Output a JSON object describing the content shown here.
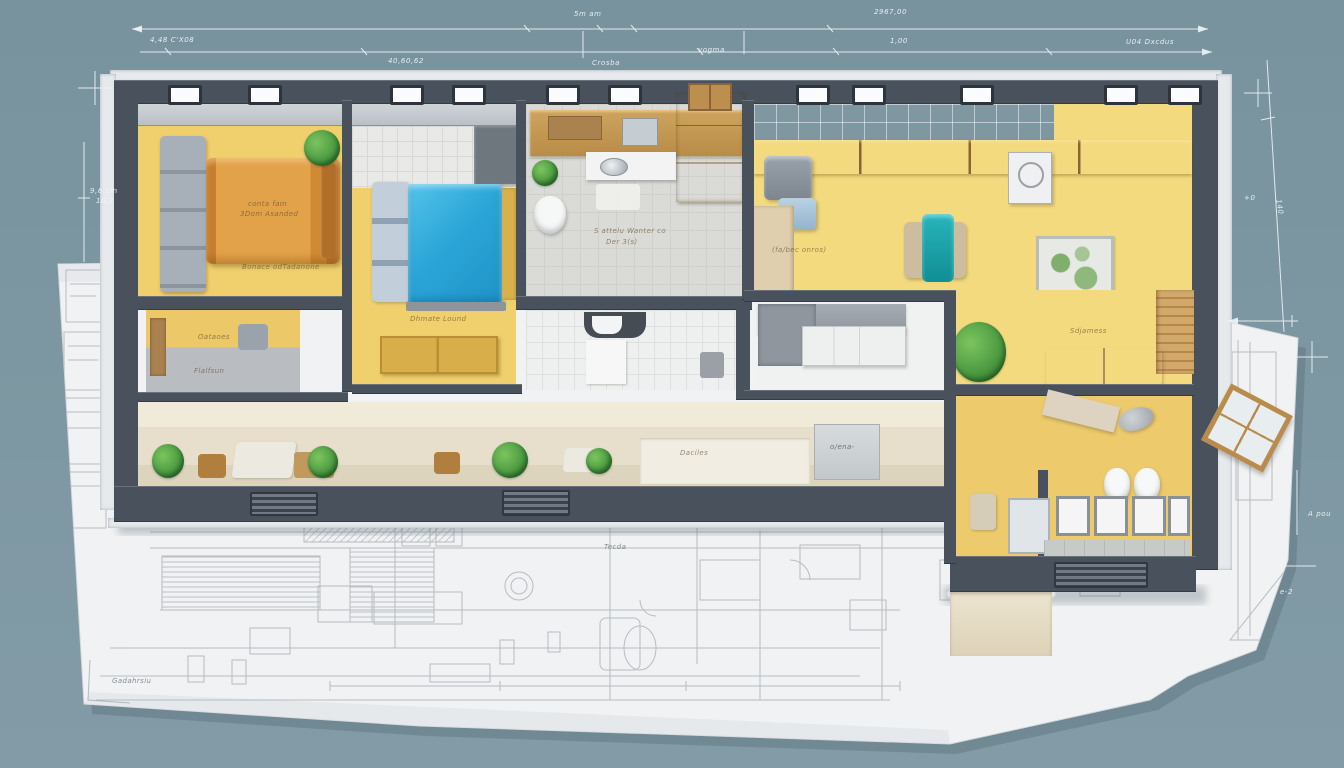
{
  "scene": {
    "description": "3D cutaway apartment floor-plan model standing on a 2D architectural blueprint sheet",
    "background_color": "#7d97a2",
    "paper_color": "#f1f2f3",
    "palette": {
      "wall_dark": "#49525c",
      "trim_light": "#e7eaed",
      "floor_yellow": "#f0cf6d",
      "floor_yellow_light": "#f4da7e",
      "bed_orange": "#d9933c",
      "bed_blue": "#2ba6d8",
      "chaise_teal": "#17a4ab",
      "wood": "#c2954e",
      "tile_gray": "#dadbd7",
      "corridor_cream": "#ece5d4",
      "plant_green": "#4e9c42",
      "dimension_line": "#eef4f6"
    }
  },
  "annotations": {
    "dimensions": [
      {
        "text": "4,48 C'X08"
      },
      {
        "text": "5m am"
      },
      {
        "text": "2967,00"
      },
      {
        "text": "1,00"
      },
      {
        "text": "U04 Dxcdus"
      },
      {
        "text": "Crosba"
      },
      {
        "text": "vogma"
      },
      {
        "text": "40,60,62"
      },
      {
        "text": "9,6 cm"
      },
      {
        "text": "10,2"
      },
      {
        "text": "140"
      },
      {
        "text": "+0"
      },
      {
        "text": "A pou"
      },
      {
        "text": "e-2"
      }
    ],
    "room_labels": [
      {
        "text": "conta fam"
      },
      {
        "text": "3Dom Asanded"
      },
      {
        "text": "Bonace odTadanone"
      },
      {
        "text": "Oataoes"
      },
      {
        "text": "Flalfsun"
      },
      {
        "text": "Dhmate Lound"
      },
      {
        "text": "S attelu Wanter co"
      },
      {
        "text": "Der 3(s)"
      },
      {
        "text": "(fa/bec onros)"
      },
      {
        "text": "Sdjamess"
      },
      {
        "text": "o/ena-"
      },
      {
        "text": "Daciles"
      }
    ],
    "paper_labels": [
      {
        "text": "Gadahrsiu"
      },
      {
        "text": "Tecda"
      }
    ]
  }
}
